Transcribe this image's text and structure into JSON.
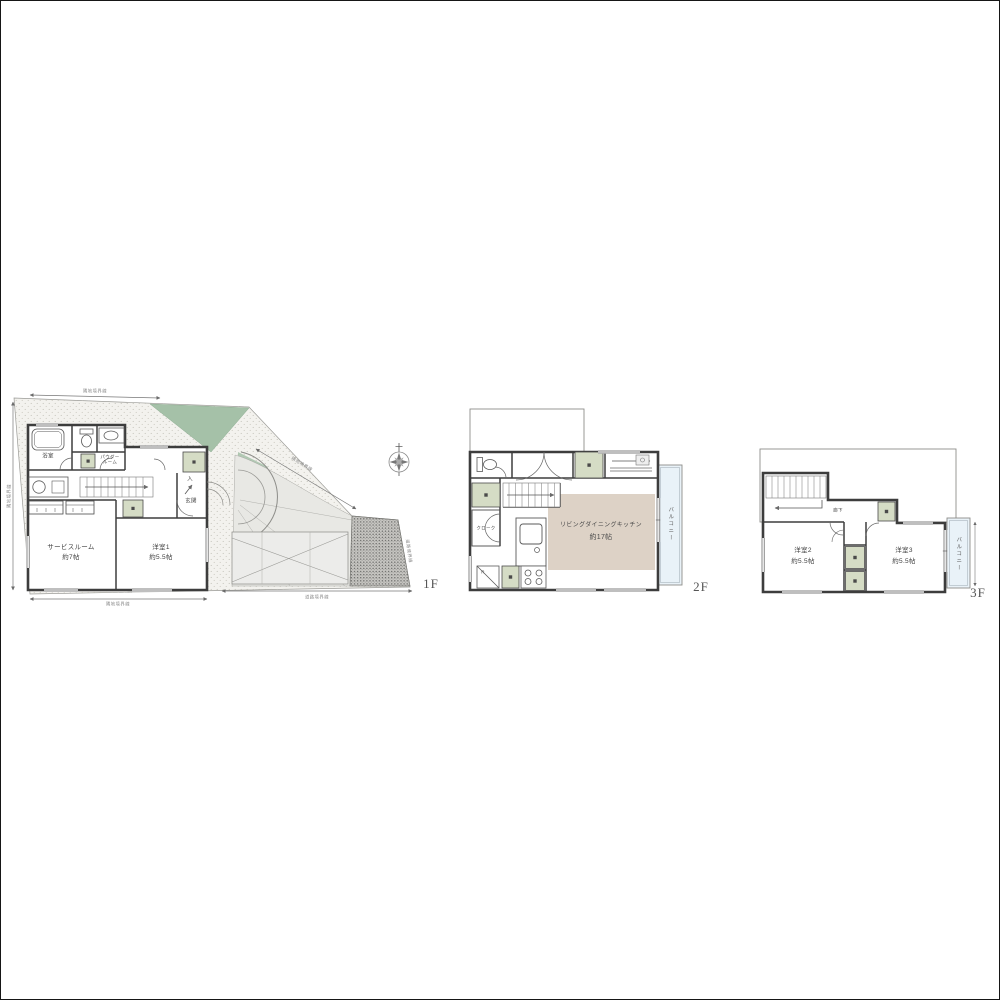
{
  "floors": {
    "f1": {
      "floor_label": "1F",
      "rooms": {
        "bath": "浴室",
        "powder_room": "パウダー\nルーム",
        "service_room": {
          "name": "サービスルーム",
          "size": "約7帖"
        },
        "western1": {
          "name": "洋室1",
          "size": "約5.5帖"
        },
        "entrance": "玄関",
        "entry_mark": "入"
      }
    },
    "f2": {
      "floor_label": "2F",
      "rooms": {
        "ldk": {
          "name": "リビングダイニングキッチン",
          "size": "約17帖"
        },
        "balcony": "バルコニー",
        "refrigerator_mark": "R",
        "cloak": "クローク"
      }
    },
    "f3": {
      "floor_label": "3F",
      "rooms": {
        "hallway": "廊下",
        "western2": {
          "name": "洋室2",
          "size": "約5.5帖"
        },
        "western3": {
          "name": "洋室3",
          "size": "約5.5帖"
        },
        "balcony": "バルコニー"
      }
    }
  },
  "site": {
    "boundary_neighbor": "隣地境界線",
    "boundary_road": "道路境界線"
  },
  "colors": {
    "wall": "#3d3d3d",
    "planting_green": "#a5c1a8",
    "storage_green": "#d5dcc5",
    "ldk_beige": "#ddd2c6",
    "balcony_blue": "#e9f2f8",
    "ground_stipple": "#f3f2ee",
    "slope_gravel": "#c8c7c3"
  }
}
